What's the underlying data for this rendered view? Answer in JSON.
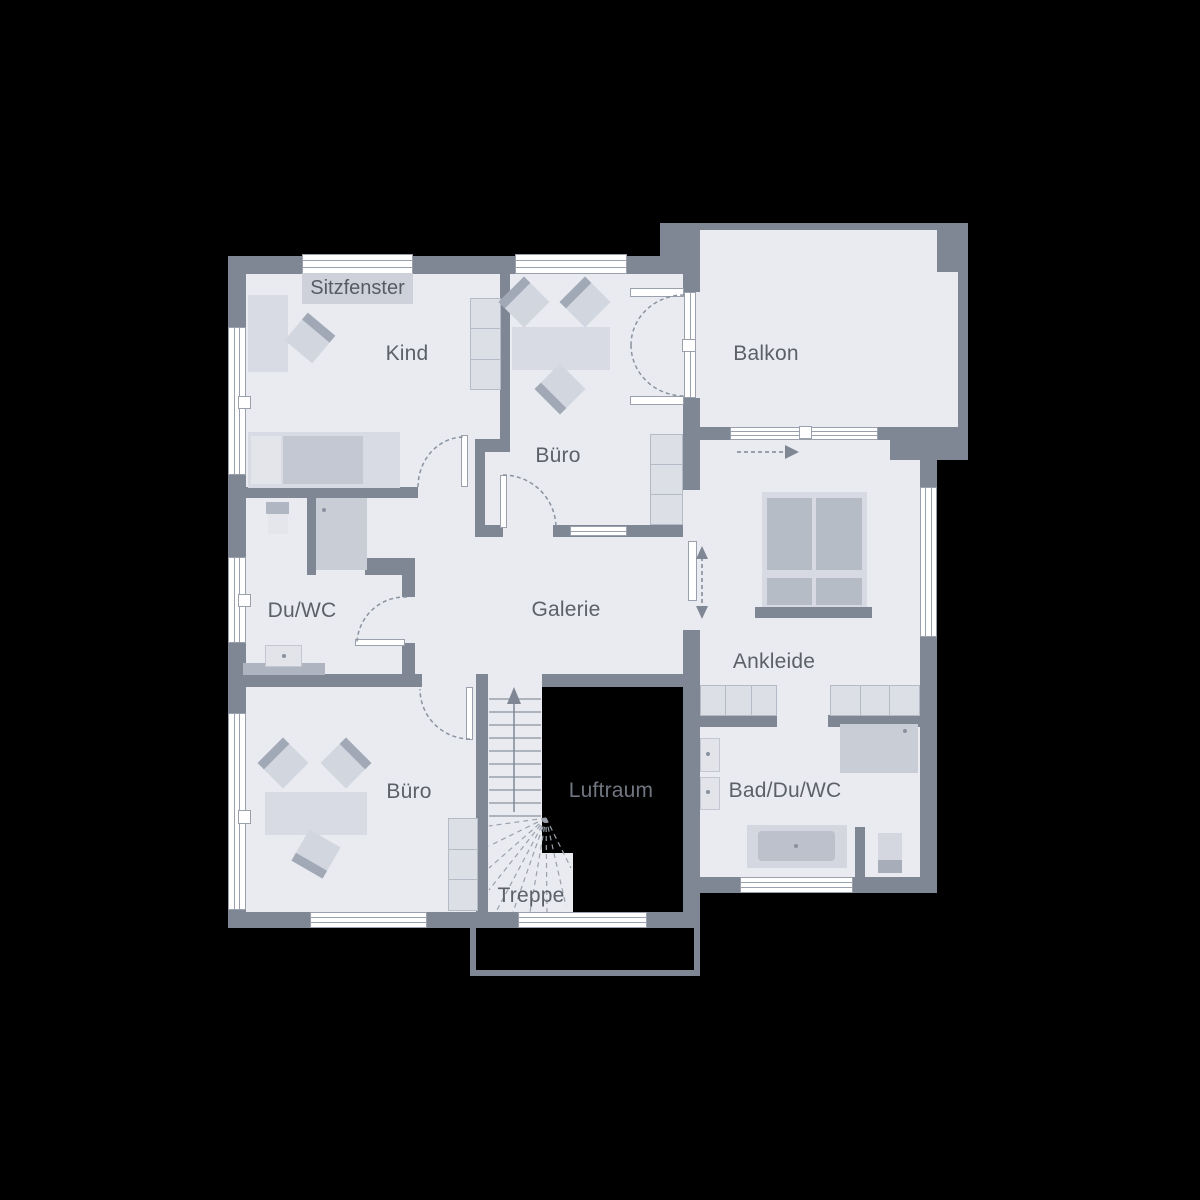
{
  "plan": {
    "type": "floor-plan",
    "floor_name_visible": false,
    "background": "#000000"
  },
  "colors": {
    "wall": "#7f8795",
    "floor": "#e9ebf1",
    "window": "#ffffff",
    "window_line": "#9aa1ac",
    "furniture_light": "#d8dbe3",
    "furniture_mid": "#c3c8d2",
    "furniture_dark": "#a2a9b6",
    "label_text": "#5c6168",
    "luftraum_text": "#70767f",
    "void": "#000000"
  },
  "rooms": [
    {
      "id": "kind",
      "label": "Kind"
    },
    {
      "id": "buero_top",
      "label": "Büro"
    },
    {
      "id": "balkon",
      "label": "Balkon"
    },
    {
      "id": "du_wc",
      "label": "Du/WC"
    },
    {
      "id": "galerie",
      "label": "Galerie"
    },
    {
      "id": "ankleide",
      "label": "Ankleide"
    },
    {
      "id": "buero_bottom",
      "label": "Büro"
    },
    {
      "id": "luftraum",
      "label": "Luftraum"
    },
    {
      "id": "bad_du_wc",
      "label": "Bad/Du/WC"
    },
    {
      "id": "treppe",
      "label": "Treppe"
    }
  ],
  "annotations": {
    "sitzfenster": "Sitzfenster"
  }
}
